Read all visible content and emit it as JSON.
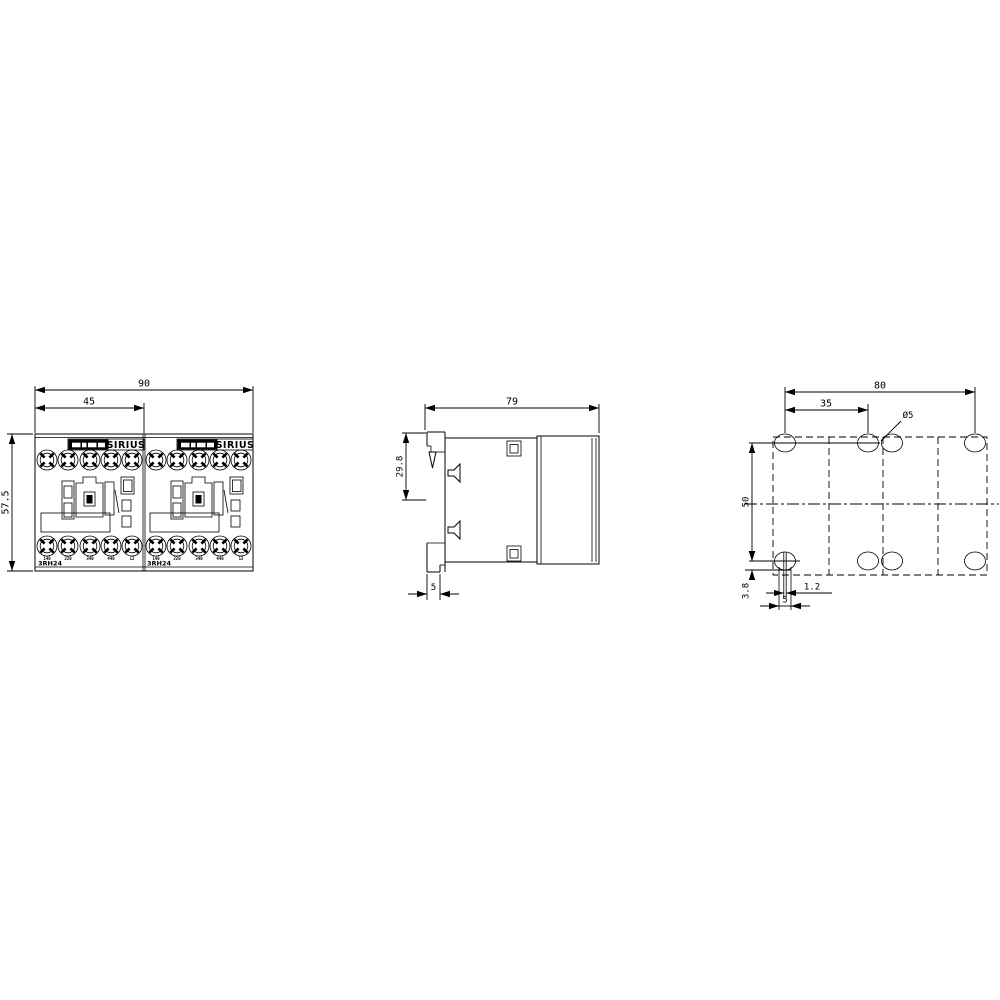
{
  "drawing": {
    "type": "technical dimensional drawing",
    "background": "#ffffff",
    "line_color": "#000000"
  },
  "views": {
    "front": {
      "dims": {
        "total_width": "90",
        "module_width": "45",
        "height": "57.5"
      },
      "modules": [
        {
          "brand": "SIRIUS",
          "model": "3RH24",
          "terminals": [
            "140",
            "220",
            "340",
            "440",
            "12"
          ]
        },
        {
          "brand": "SIRIUS",
          "model": "3RH24",
          "terminals": [
            "140",
            "220",
            "340",
            "440",
            "12"
          ]
        }
      ]
    },
    "side": {
      "dims": {
        "depth": "79",
        "rail_offset": "29.8",
        "plate_thickness": "5"
      }
    },
    "drilling": {
      "dims": {
        "hole_span_width": "80",
        "hole_pitch": "35",
        "hole_diameter": "Ø5",
        "hole_span_height": "50",
        "bottom_offset": "3.8",
        "slot_width": "1.2",
        "hole_width": "5"
      }
    }
  }
}
